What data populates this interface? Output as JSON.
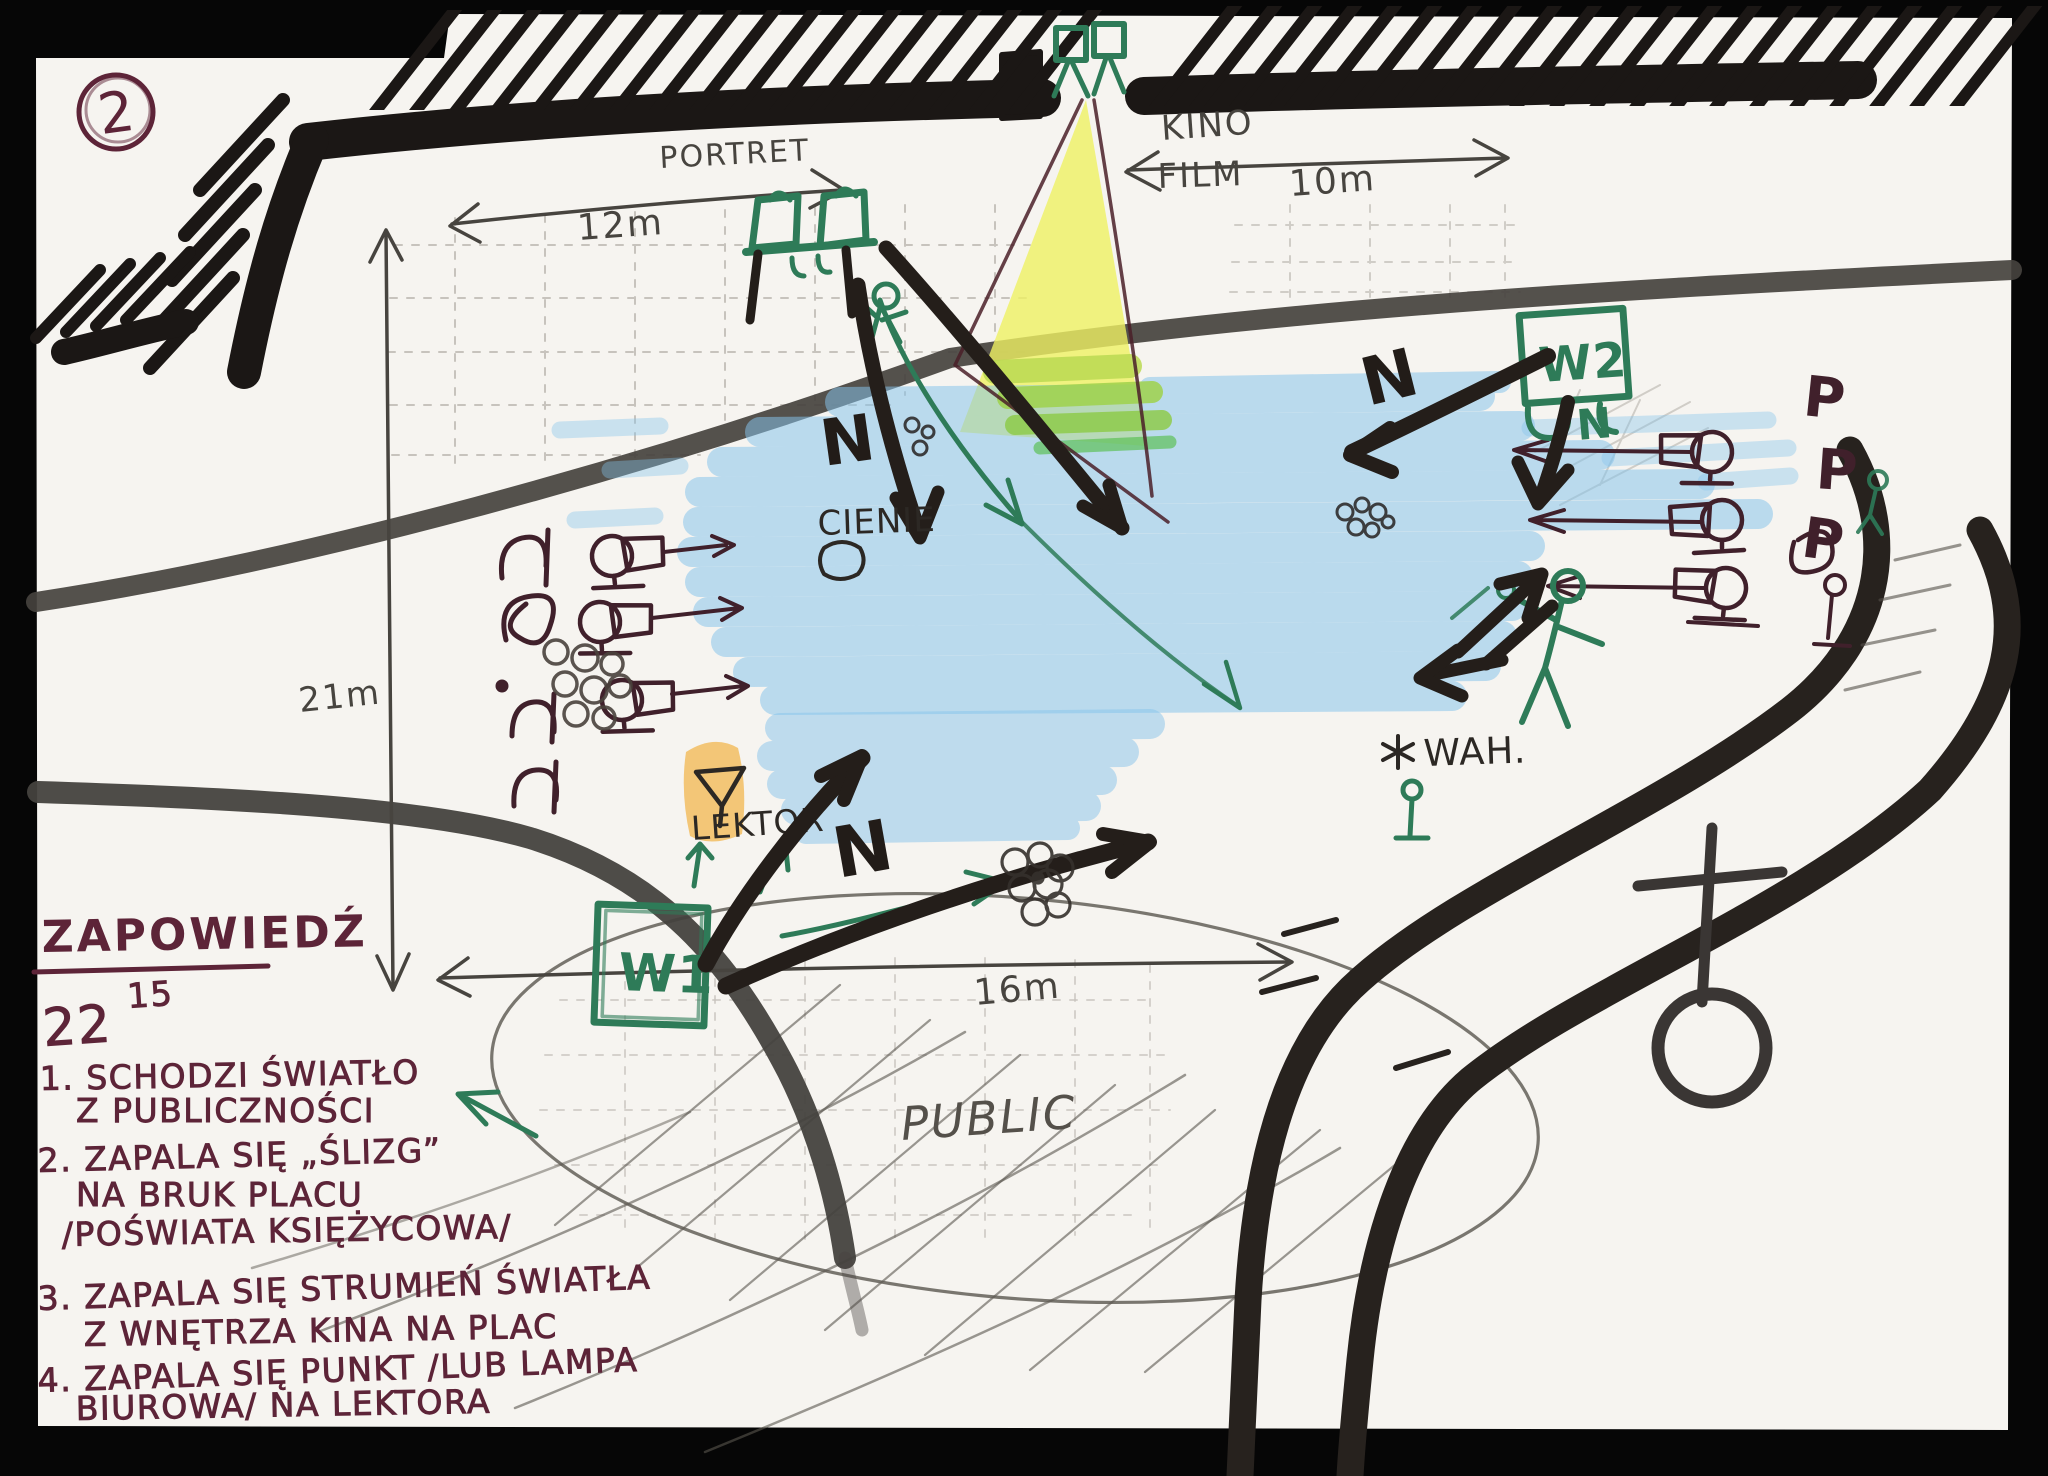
{
  "page": {
    "badge": "2"
  },
  "map": {
    "dimensions": {
      "portret": {
        "label": "PORTRET",
        "value": "12m"
      },
      "kino": {
        "label": "KINO",
        "film": "FILM",
        "value": "10m"
      },
      "depth": "21m",
      "front": "16m"
    },
    "labels": {
      "w1": "W1",
      "w2": "W2",
      "cienie": "CIENIE",
      "lektor": "LEKTOR",
      "wah": "WAH.",
      "public": "PUBLIC",
      "n_green": "N"
    },
    "n_letters": [
      "N",
      "N",
      "N"
    ],
    "p_letters": [
      "P",
      "P",
      "P"
    ],
    "icons": {
      "wah_star": "asterisk-icon",
      "lektor_glyph": "triangle-lectern-icon",
      "bottom_right": "cross-over-circle-icon"
    },
    "colors": {
      "paper": "#f6f4f0",
      "wall_ink": "#1b1715",
      "marker_black": "#241e1a",
      "note_maroon": "#5d2438",
      "sketch_maroon": "#40202b",
      "marker_green": "#2e7b58",
      "marker_blue": "#85c4ec",
      "beam_yellow": "#eff163",
      "lektor_orange": "#f2bd62",
      "pencil_gray": "#47443f"
    }
  },
  "notes": {
    "heading": "ZAPOWIEDŹ",
    "time": {
      "hour": "22",
      "minutes": "15"
    },
    "items": [
      {
        "lines": [
          "1. SCHODZI ŚWIATŁO",
          "Z PUBLICZNOŚCI"
        ]
      },
      {
        "lines": [
          "2. ZAPALA SIĘ „ŚLIZG”",
          "NA BRUK PLACU",
          "/POŚWIATA KSIĘŻYCOWA/"
        ]
      },
      {
        "lines": [
          "3. ZAPALA SIĘ STRUMIEŃ ŚWIATŁA",
          "Z WNĘTRZA KINA NA PLAC"
        ]
      },
      {
        "lines": [
          "4. ZAPALA SIĘ PUNKT /LUB LAMPA",
          "BIUROWA/ NA LEKTORA"
        ]
      }
    ]
  }
}
